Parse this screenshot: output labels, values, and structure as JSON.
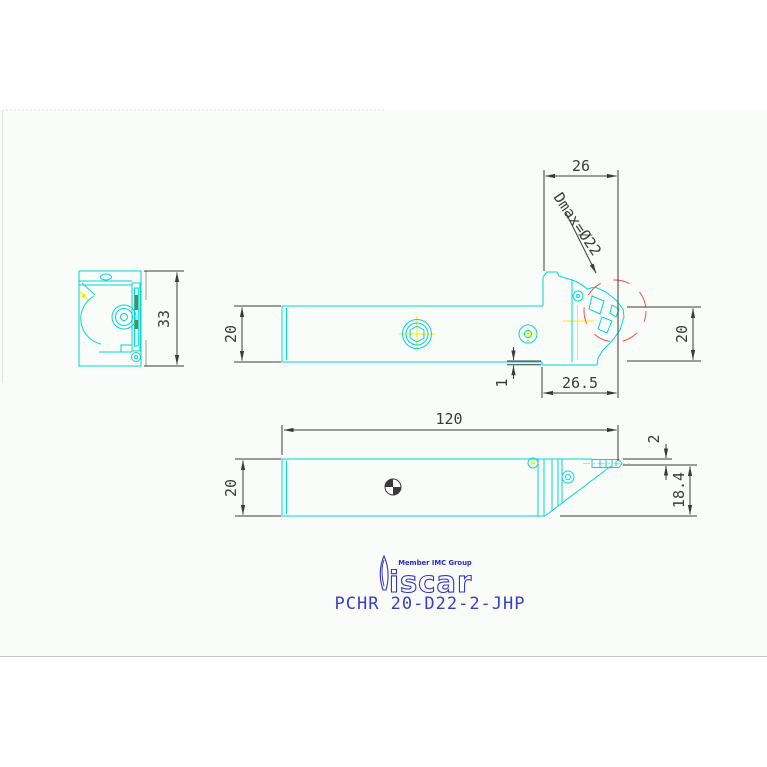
{
  "title_block": {
    "part_number": "PCHR 20-D22-2-JHP",
    "brand": "iscar",
    "member_text": "Member IMC Group"
  },
  "annotations": {
    "dmax": "Dmax=Ø22"
  },
  "dimensions": {
    "head_top_width": "26",
    "end_view_height": "33",
    "side_height_left": "20",
    "side_height_right": "20",
    "under_step": "1",
    "head_length": "26.5",
    "overall_length": "120",
    "bottom_height": "20",
    "insert_width": "2",
    "head_side_depth": "18.4"
  },
  "colors": {
    "geometry_cyan": "#00d8d8",
    "centerline_yellow": "#f0f000",
    "max_diameter_red": "#ff4a4a",
    "dimension_gray": "#3a3a3a",
    "brand_blue": "#3535c5"
  }
}
